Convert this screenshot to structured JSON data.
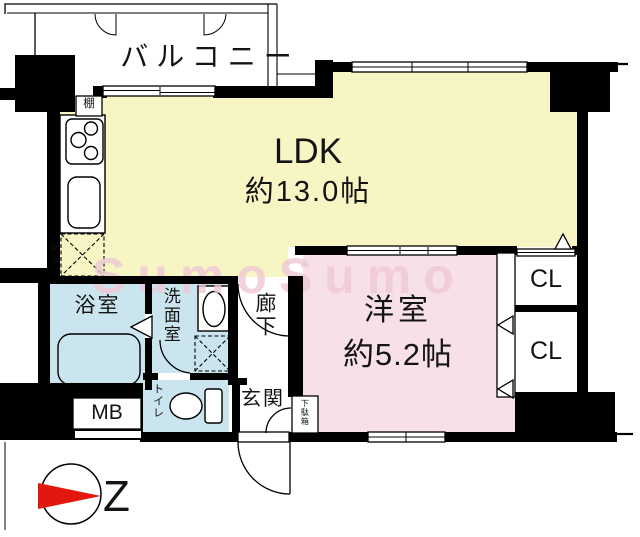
{
  "floorplan": {
    "rooms": {
      "balcony": {
        "label": "バルコニー"
      },
      "ldk": {
        "label": "LDK",
        "size": "約13.0帖"
      },
      "western_room": {
        "label": "洋室",
        "size": "約5.2帖"
      },
      "closet_upper": {
        "label": "CL"
      },
      "closet_lower": {
        "label": "CL"
      },
      "bathroom": {
        "label": "浴室"
      },
      "washroom": {
        "label": "洗面室"
      },
      "hallway": {
        "label": "廊下"
      },
      "toilet": {
        "label": "トイレ"
      },
      "entrance": {
        "label": "玄関"
      },
      "shoe_cabinet": {
        "label": "下駄箱"
      },
      "meter_box": {
        "label": "MB"
      },
      "shelf": {
        "label": "棚"
      },
      "pipe_space": {
        "label": "PS"
      }
    },
    "watermark": "SumoSumo",
    "compass": {
      "north_label": "Z"
    },
    "colors": {
      "ldk": "#F8F5C4",
      "western": "#F8E0EA",
      "wet": "#CBE5EF",
      "wall": "#000000",
      "watermark": "#EFC9D5",
      "compass": "#E3170D"
    }
  }
}
